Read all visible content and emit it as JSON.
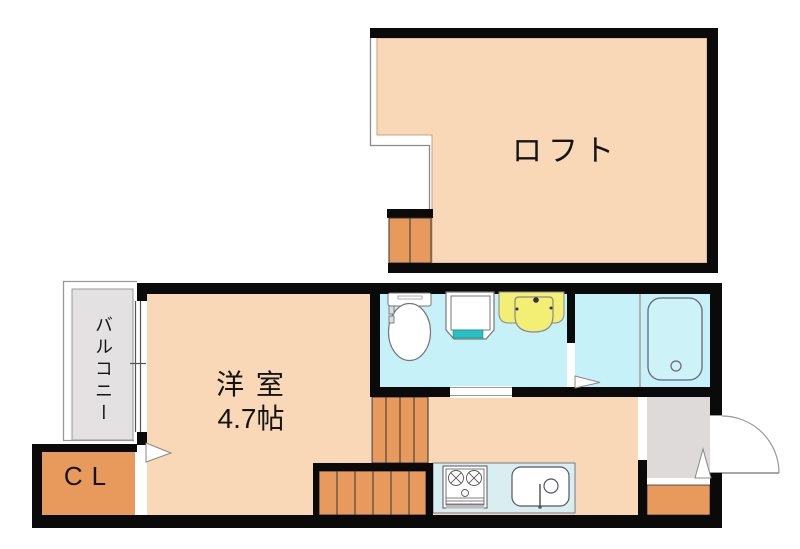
{
  "floorplan": {
    "loft": {
      "label": "ロフト"
    },
    "room": {
      "label": "洋 室",
      "size": "4.7帖"
    },
    "balcony": {
      "label": "バルコニー"
    },
    "closet": {
      "label": "CL"
    },
    "fixtures": [
      "toilet",
      "washing-machine-pan",
      "washbasin",
      "bathtub",
      "gas-stove",
      "kitchen-sink",
      "entrance-door",
      "window",
      "loft-ladder",
      "staircase"
    ],
    "colors": {
      "wall": "#0a0a0a",
      "room_fill": "#f8d8b6",
      "wet_area_fill": "#c6f1f8",
      "stairs_closet_fill": "#e8995c",
      "balcony_fill": "#e3e1e1",
      "entrance_fill": "#dedad9",
      "counter_fill": "#d9eef1",
      "washbasin_fill": "#f2ef74",
      "washer_pan_accent": "#2abfc0"
    }
  }
}
